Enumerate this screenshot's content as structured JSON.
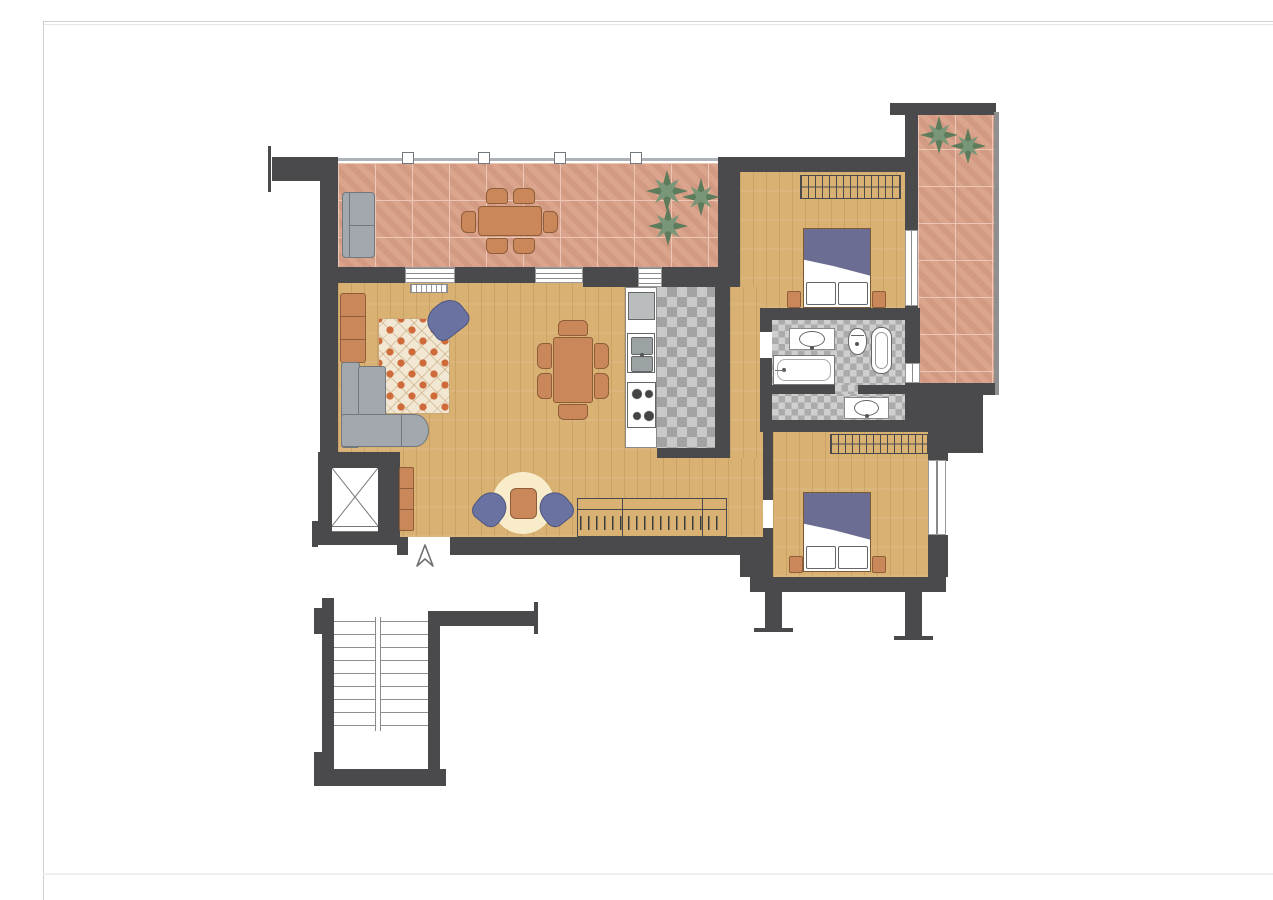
{
  "document": {
    "kind": "apartment-floor-plan",
    "background": "#ffffff"
  },
  "palette": {
    "wall": "#4a4a4c",
    "wood_floor": "#d9b273",
    "terrace_brick": "#d99f87",
    "brick_grout": "#ecc7b5",
    "kitchen_tile_light": "#c9c9c9",
    "kitchen_tile_dark": "#a3a3a3",
    "bath_tile_light": "#cfcfcf",
    "bath_tile_dark": "#ababab",
    "sofa_gray": "#a2a8ad",
    "furniture_terracotta": "#c9875a",
    "furniture_outline": "#8f5d38",
    "rug_cream": "#f1e7d2",
    "rug_orange": "#cf6b3a",
    "round_rug_cream": "#f8ecca",
    "chair_blue": "#6a72a2",
    "bed_blanket_purple": "#6c6d92",
    "plant_green": "#5d7c5c",
    "railing_gray": "#adb3b8",
    "page_frame_gray": "#cfcfcf"
  },
  "rooms": {
    "terrace_top": {
      "furniture": [
        "outdoor-sofa",
        "dining-table",
        "dining-chairs",
        "plants"
      ]
    },
    "living_room": {
      "furniture": [
        "corner-sofa",
        "patterned-rug",
        "armchair",
        "wall-bench",
        "dining-table",
        "dining-chairs",
        "round-rug",
        "coffee-table",
        "tub-chairs",
        "sideboard-with-hangers",
        "entry-cabinet",
        "radiator"
      ]
    },
    "kitchen": {
      "furniture": [
        "fridge",
        "sink",
        "stove",
        "counter"
      ]
    },
    "bathroom": {
      "furniture": [
        "washbasin",
        "toilet",
        "bidet",
        "bathtub",
        "washbasin-2"
      ]
    },
    "bedroom_top": {
      "furniture": [
        "double-bed",
        "wardrobe",
        "nightstand-left",
        "nightstand-right"
      ]
    },
    "bedroom_bottom": {
      "furniture": [
        "double-bed",
        "wardrobe",
        "nightstand-left",
        "nightstand-right"
      ]
    },
    "terrace_right": {
      "furniture": [
        "plants"
      ]
    },
    "stairwell": {
      "furniture": [
        "stairs",
        "handrail"
      ]
    },
    "elevator": {
      "furniture": []
    }
  },
  "markers": {
    "entrance_arrow_icon": "triangle-arrow-up"
  }
}
